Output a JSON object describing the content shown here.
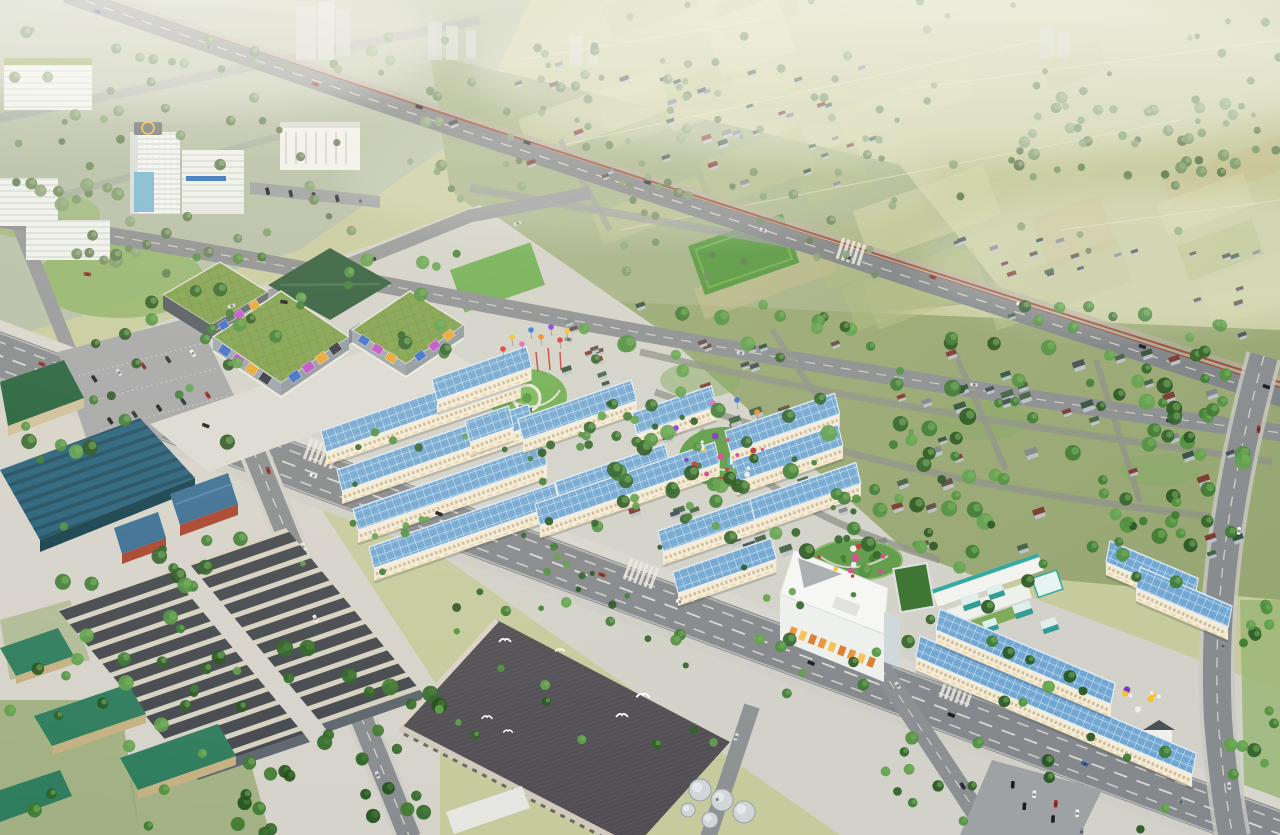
{
  "meta": {
    "title": "Aerial 3D master-plan rendering of a mixed-use urban development with shophouse rows, shopping mall, industrial warehouses and surrounding village and farmland",
    "type": "architectural-aerial-render",
    "visible_text": "none"
  },
  "palette": {
    "farm_base": "#c6cb9e",
    "urban_topleft": "#b6bfa7",
    "town_strip": "#a4b186",
    "village_ground": "#97a773",
    "project_ground": "#d2d2ca",
    "industrial_ground": "#d6d3cb",
    "road_asphalt": "#85888c",
    "road_minor": "#8b8e91",
    "sidewalk": "#d7d6cf",
    "railway": "#9a4a3c",
    "solar_roof": "#74a9d4",
    "row_facade": "#f3ecd9",
    "mall_roof": "#7fa04b",
    "mall_facade": "#9aa3ab",
    "dark_green_roof": "#2c5a38",
    "teal_warehouse": "#26607a",
    "warehouse_dark": "#45494e",
    "warehouse_stripe": "#d6d2c2",
    "green_shed": "#2f7d5e",
    "factory_roof": "#504e53",
    "office_white": "#eef0ee",
    "school_teal": "#2ea8a0",
    "helipad_yellow": "#f2c12e",
    "park_lawn": "#6fae52"
  },
  "tree_palettes": {
    "vivid": [
      "#2f6128",
      "#3c7a32",
      "#4f8f3f",
      "#5fa04c",
      "#27541f"
    ],
    "muted": [
      "#6d8a5c",
      "#7d9a6b",
      "#5f7a50",
      "#8aa378"
    ],
    "dark": [
      "#1f4f1a",
      "#2f6628",
      "#3f7a30"
    ],
    "vivid_hl": "#74b35c",
    "muted_hl": "#a3b98c",
    "dark_hl": "#4d7f3a"
  },
  "roof_colors": [
    "#7a352c",
    "#3f4a52",
    "#3f6042",
    "#7f868c",
    "#2f4f3a",
    "#5a4a42"
  ],
  "car_colors": [
    "#f4f4f4",
    "#1a1d22",
    "#8e959b",
    "#3a63a8",
    "#a03028",
    "#d8dadb",
    "#2e3136"
  ],
  "billboard_colors": [
    "#3a6cc8",
    "#c050c8",
    "#e8a62e",
    "#35353f",
    "#f0f0ee",
    "#7a4fa0",
    "#e8619a",
    "#f2c12e"
  ],
  "office_band_colors": [
    "#e8973c",
    "#f5c35a",
    "#d97f2e"
  ],
  "balloon_colors": [
    "#e03a3a",
    "#f5c12e",
    "#e86ab0",
    "#3a78d8",
    "#f08a2e",
    "#8a3ae0"
  ],
  "flower_colors": [
    "#d84a8a",
    "#c23a3a",
    "#eeeeee",
    "#f5c12e",
    "#7a3ab8",
    "#3f7a30"
  ],
  "patch_colors": [
    "#bcc48e",
    "#cdd1a0",
    "#aeb97e",
    "#d6d8ab",
    "#c8bd8f",
    "#b5be85"
  ],
  "scene": {
    "rows": [
      [
        326,
        452,
        206,
        -19
      ],
      [
        342,
        491,
        202,
        -19
      ],
      [
        358,
        530,
        200,
        -19
      ],
      [
        374,
        568,
        196,
        -19
      ],
      [
        437,
        400,
        100,
        -19
      ],
      [
        470,
        442,
        46,
        -19
      ],
      [
        523,
        440,
        120,
        -19
      ],
      [
        637,
        434,
        84,
        -19
      ],
      [
        560,
        503,
        116,
        -19
      ],
      [
        540,
        525,
        190,
        -19
      ],
      [
        663,
        552,
        108,
        -19
      ],
      [
        678,
        593,
        104,
        -19
      ],
      [
        730,
        452,
        116,
        -19
      ],
      [
        737,
        482,
        112,
        -19
      ],
      [
        755,
        520,
        112,
        -19
      ],
      [
        916,
        657,
        300,
        23
      ],
      [
        936,
        630,
        190,
        23
      ],
      [
        1106,
        562,
        96,
        23
      ],
      [
        1136,
        588,
        100,
        23
      ]
    ],
    "trees": [
      [
        0,
        30,
        460,
        220,
        55,
        3,
        6,
        "muted",
        11
      ],
      [
        430,
        50,
        470,
        160,
        48,
        3,
        5,
        "muted",
        12
      ],
      [
        500,
        0,
        780,
        140,
        40,
        2.5,
        4.5,
        "muted",
        13
      ],
      [
        1000,
        85,
        280,
        95,
        40,
        3,
        6,
        "muted",
        35
      ],
      [
        620,
        150,
        560,
        130,
        36,
        3,
        5,
        "muted",
        36
      ],
      [
        580,
        305,
        690,
        250,
        150,
        4,
        8.5,
        "vivid",
        14
      ],
      [
        150,
        240,
        330,
        115,
        24,
        4,
        7,
        "vivid",
        15
      ],
      [
        86,
        318,
        160,
        140,
        13,
        4,
        7,
        "vivid",
        16
      ],
      [
        300,
        420,
        340,
        185,
        28,
        2.5,
        4.5,
        "vivid",
        17
      ],
      [
        530,
        400,
        400,
        215,
        30,
        2.5,
        4.5,
        "vivid",
        18
      ],
      [
        235,
        648,
        205,
        187,
        28,
        5,
        9,
        "dark",
        19
      ],
      [
        0,
        420,
        250,
        270,
        24,
        4,
        8,
        "vivid",
        20
      ],
      [
        0,
        640,
        270,
        195,
        24,
        4,
        8,
        "vivid",
        21
      ],
      [
        755,
        520,
        450,
        185,
        36,
        4,
        7,
        "vivid",
        22
      ],
      [
        880,
        690,
        400,
        145,
        20,
        4,
        7,
        "vivid",
        23
      ],
      [
        420,
        600,
        330,
        150,
        20,
        3,
        6,
        "vivid",
        24
      ],
      [
        1230,
        590,
        50,
        245,
        12,
        4,
        7,
        "vivid",
        26
      ],
      [
        40,
        180,
        200,
        100,
        18,
        4,
        7,
        "muted",
        27
      ]
    ],
    "houses": [
      [
        600,
        325,
        640,
        230,
        78,
        9,
        31
      ],
      [
        440,
        60,
        440,
        130,
        38,
        7,
        32
      ],
      [
        950,
        230,
        320,
        85,
        22,
        7,
        33
      ],
      [
        560,
        295,
        100,
        90,
        10,
        8,
        37
      ]
    ],
    "lanes": [
      [
        66,
        -4,
        1288,
        398,
        12,
        51
      ],
      [
        0,
        258,
        1280,
        432,
        6,
        52
      ],
      [
        -5,
        350,
        1285,
        836,
        10,
        53
      ],
      [
        238,
        408,
        404,
        832,
        3,
        54
      ],
      [
        1260,
        380,
        1222,
        700,
        3,
        55
      ],
      [
        866,
        642,
        988,
        834,
        2,
        56
      ],
      [
        170,
        332,
        585,
        196,
        3,
        57
      ],
      [
        750,
        708,
        710,
        836,
        2,
        58
      ],
      [
        1230,
        740,
        1236,
        834,
        1,
        59
      ]
    ],
    "parked": [
      [
        82,
        382,
        205,
        350,
        5,
        61
      ],
      [
        98,
        424,
        220,
        392,
        5,
        62
      ],
      [
        256,
        190,
        372,
        202,
        5,
        63
      ],
      [
        1002,
        780,
        1088,
        818,
        4,
        64
      ],
      [
        1010,
        800,
        1096,
        838,
        3,
        65
      ]
    ],
    "patches": [
      500,
      0,
      770,
      290,
      22,
      41
    ],
    "fieldpaths": [
      [
        540,
        150,
        1040,
        40
      ],
      [
        620,
        230,
        1180,
        120
      ],
      [
        1060,
        230,
        1280,
        200
      ],
      [
        900,
        90,
        1280,
        40
      ],
      [
        520,
        60,
        760,
        20
      ]
    ],
    "crosswalks": [
      [
        322,
        454,
        20.5,
        6
      ],
      [
        642,
        574,
        20.5,
        6
      ],
      [
        958,
        692,
        20.5,
        6
      ],
      [
        298,
        556,
        69,
        4
      ],
      [
        852,
        252,
        17.5,
        5
      ]
    ],
    "balloons": [
      [
        503,
        349
      ],
      [
        512,
        337
      ],
      [
        522,
        344
      ],
      [
        531,
        330
      ],
      [
        541,
        337
      ],
      [
        551,
        327
      ],
      [
        560,
        340
      ],
      [
        567,
        331
      ],
      [
        713,
        403
      ],
      [
        737,
        400
      ],
      [
        757,
        412
      ],
      [
        676,
        428
      ]
    ],
    "festival_poles": [
      [
        536,
        352,
        538,
        372
      ],
      [
        548,
        348,
        550,
        370
      ],
      [
        560,
        352,
        561,
        370
      ]
    ],
    "billboards": [
      {
        "x1": 218,
        "y1": 346,
        "x2": 272,
        "y2": 383,
        "n": 4,
        "w": 11,
        "h": 9,
        "set": "billboard_colors"
      },
      {
        "x1": 288,
        "y1": 381,
        "x2": 342,
        "y2": 344,
        "n": 4,
        "w": 11,
        "h": 9,
        "set": "billboard_colors"
      },
      {
        "x1": 357,
        "y1": 336,
        "x2": 398,
        "y2": 362,
        "n": 3,
        "w": 10,
        "h": 8,
        "set": "billboard_colors"
      },
      {
        "x1": 413,
        "y1": 361,
        "x2": 456,
        "y2": 330,
        "n": 3,
        "w": 10,
        "h": 8,
        "set": "billboard_colors"
      },
      {
        "x1": 216,
        "y1": 330,
        "x2": 262,
        "y2": 300,
        "n": 3,
        "w": 9,
        "h": 8,
        "set": "billboard_colors"
      },
      {
        "x1": 788,
        "y1": 630,
        "x2": 876,
        "y2": 664,
        "n": 9,
        "w": 7,
        "h": 10,
        "set": "office_band_colors"
      }
    ],
    "flowerbeds": [
      [
        725,
        457,
        40,
        26,
        18,
        71
      ],
      [
        856,
        560,
        44,
        18,
        14,
        72
      ],
      [
        1140,
        698,
        24,
        12,
        8,
        73
      ]
    ],
    "birds": [
      [
        505,
        640,
        1
      ],
      [
        487,
        717,
        0.9
      ],
      [
        508,
        731,
        0.8
      ],
      [
        622,
        715,
        1
      ],
      [
        643,
        695,
        1.1
      ],
      [
        560,
        650,
        0.8
      ]
    ],
    "silos": [
      [
        700,
        790,
        11
      ],
      [
        722,
        800,
        11
      ],
      [
        744,
        812,
        11
      ],
      [
        710,
        820,
        8
      ],
      [
        688,
        810,
        7
      ]
    ],
    "cubes": [
      [
        960,
        598,
        18,
        14
      ],
      [
        986,
        588,
        16,
        13
      ],
      [
        1012,
        606,
        18,
        14
      ],
      [
        1040,
        622,
        16,
        13
      ],
      [
        982,
        622,
        14,
        12
      ]
    ]
  }
}
